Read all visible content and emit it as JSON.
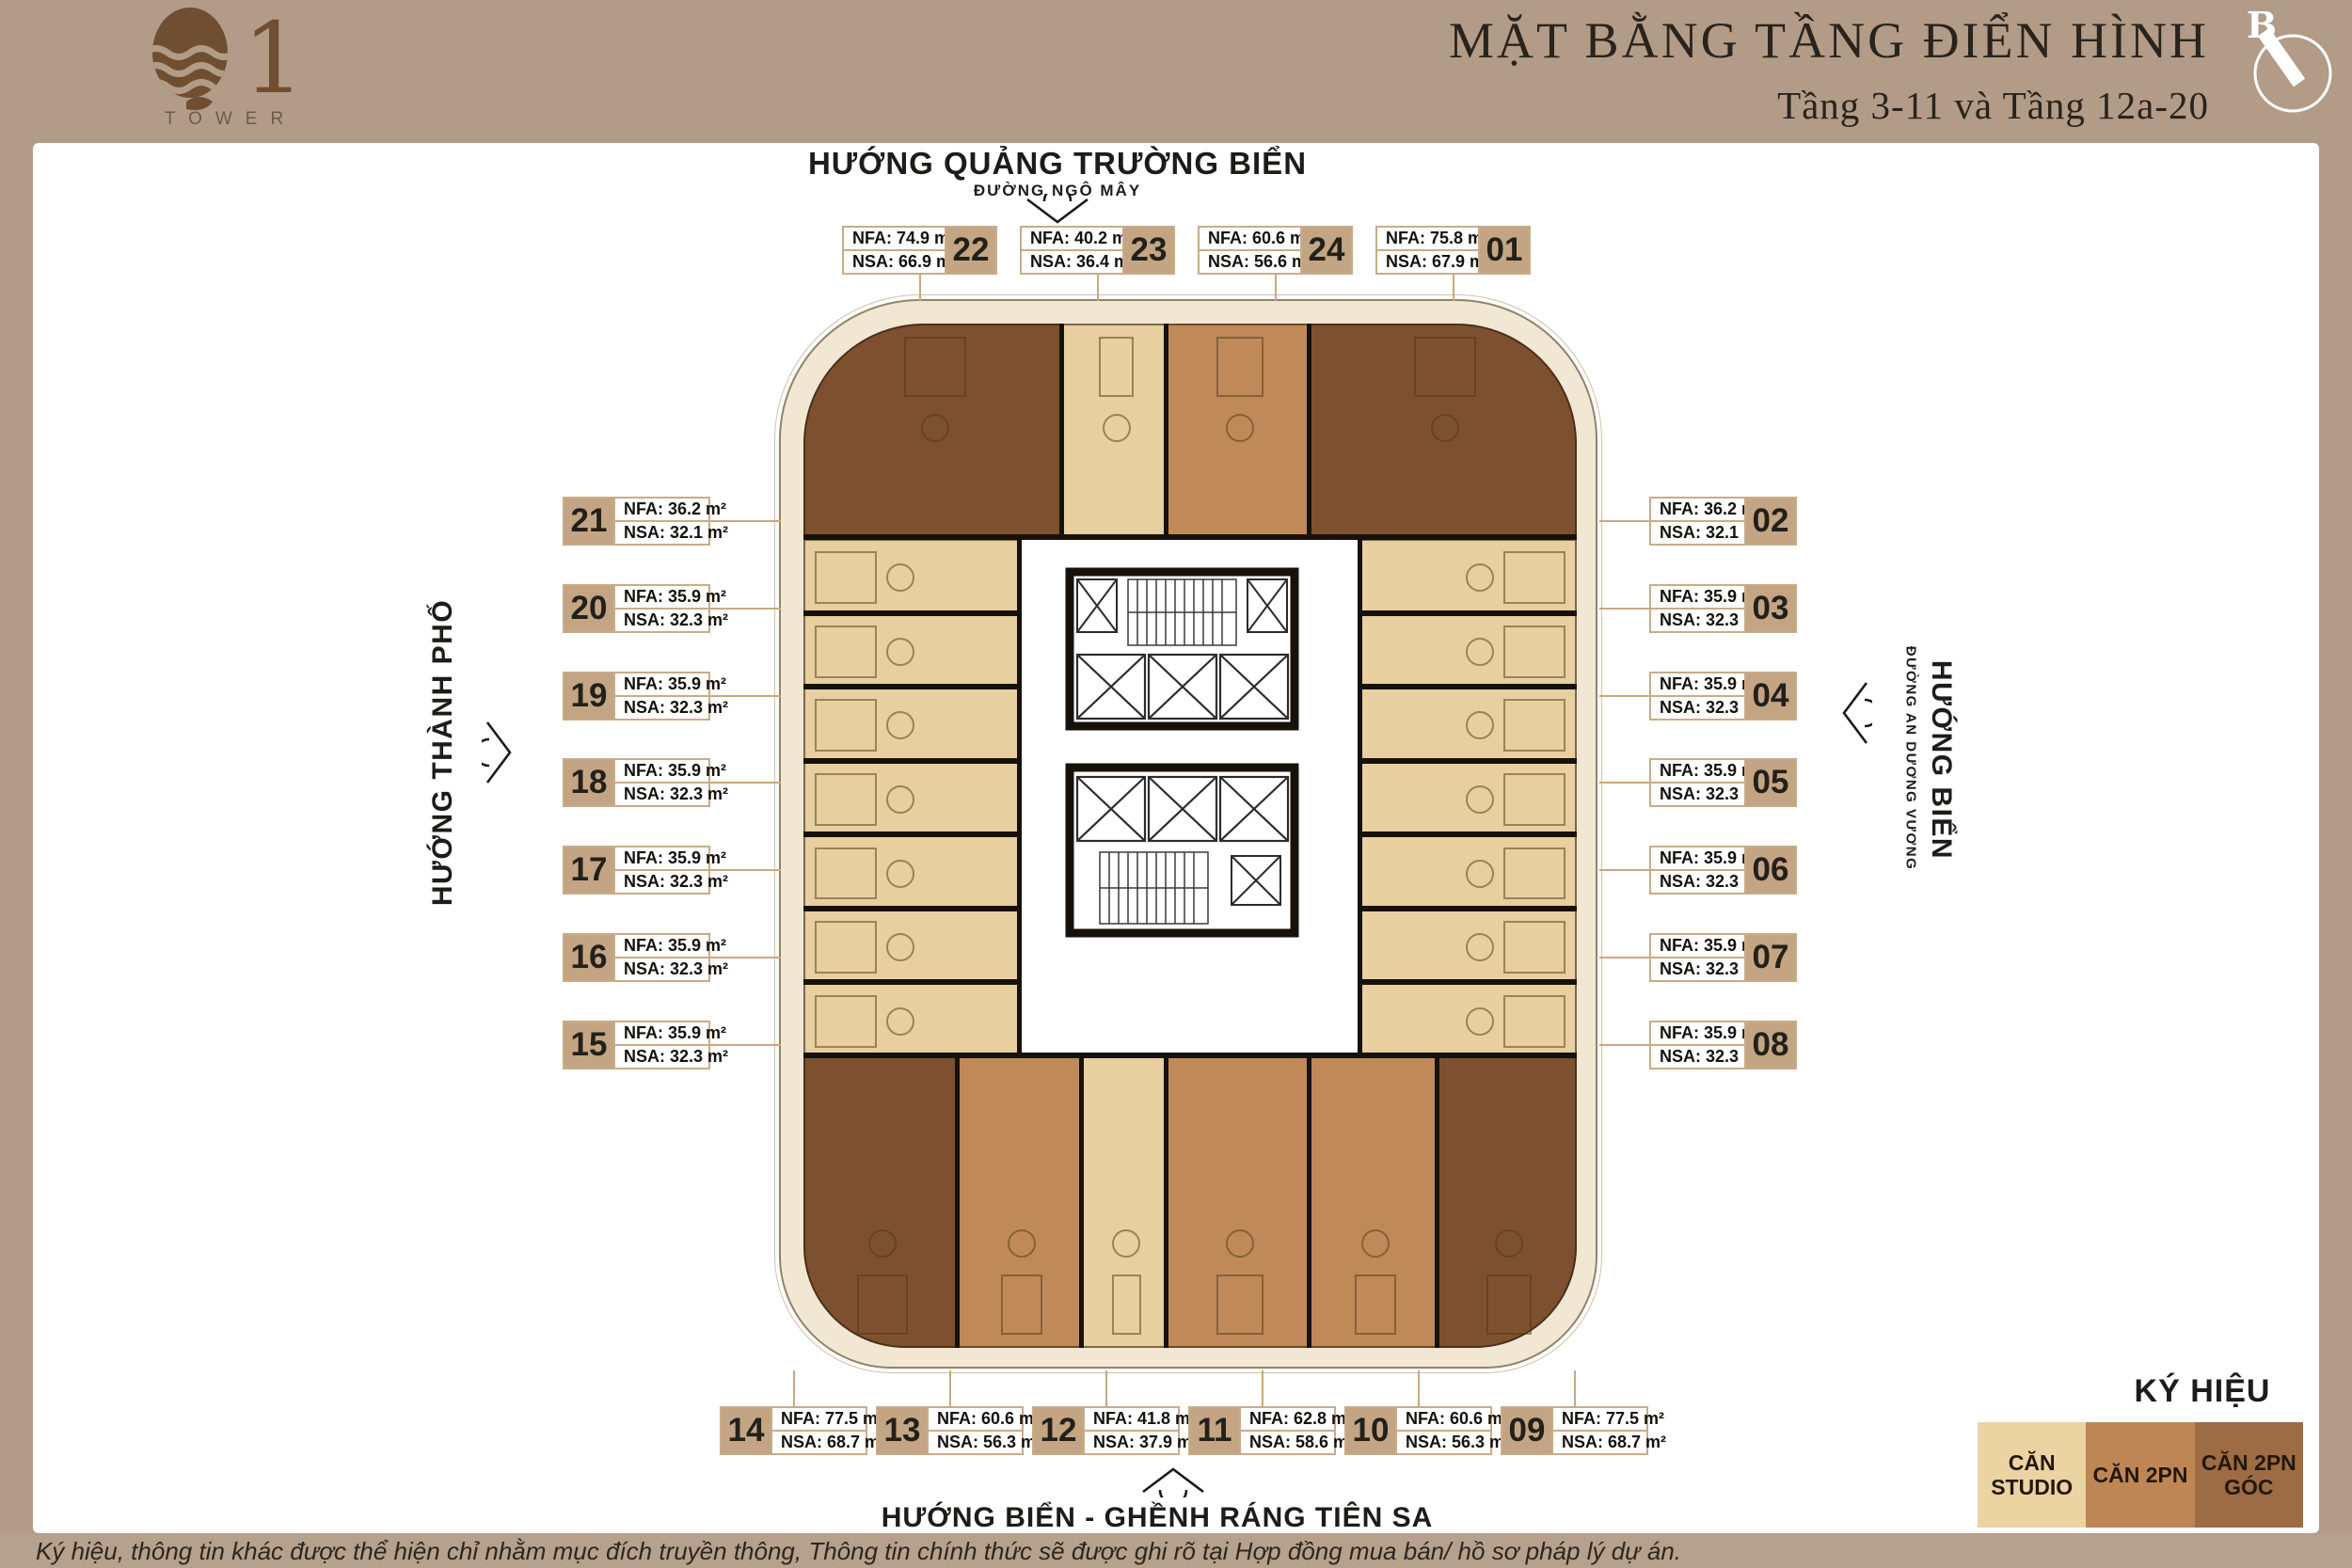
{
  "logo": {
    "mark": "Q1",
    "name": "TOWER"
  },
  "header": {
    "title": "MẶT BẰNG TẦNG ĐIỂN HÌNH",
    "subtitle": "Tầng 3-11 và Tầng 12a-20",
    "compass_label": "B"
  },
  "directions": {
    "top_heading": "HƯỚNG QUẢNG TRƯỜNG BIỂN",
    "top_road": "ĐƯỜNG NGÔ MÂY",
    "left_heading": "HƯỚNG THÀNH PHỐ",
    "right_heading": "HƯỚNG BIỂN",
    "right_road": "ĐƯỜNG AN DƯƠNG VƯƠNG",
    "bottom_heading": "HƯỚNG BIỂN - GHỀNH RÁNG TIÊN SA"
  },
  "unit_label_format": {
    "nfa_prefix": "NFA:",
    "nsa_prefix": "NSA:",
    "area_suffix": "m²"
  },
  "units": [
    {
      "id": "01",
      "nfa": "75.8",
      "nsa": "67.9",
      "type": "2pn-goc"
    },
    {
      "id": "02",
      "nfa": "36.2",
      "nsa": "32.1",
      "type": "studio"
    },
    {
      "id": "03",
      "nfa": "35.9",
      "nsa": "32.3",
      "type": "studio"
    },
    {
      "id": "04",
      "nfa": "35.9",
      "nsa": "32.3",
      "type": "studio"
    },
    {
      "id": "05",
      "nfa": "35.9",
      "nsa": "32.3",
      "type": "studio"
    },
    {
      "id": "06",
      "nfa": "35.9",
      "nsa": "32.3",
      "type": "studio"
    },
    {
      "id": "07",
      "nfa": "35.9",
      "nsa": "32.3",
      "type": "studio"
    },
    {
      "id": "08",
      "nfa": "35.9",
      "nsa": "32.3",
      "type": "studio"
    },
    {
      "id": "09",
      "nfa": "77.5",
      "nsa": "68.7",
      "type": "2pn-goc"
    },
    {
      "id": "10",
      "nfa": "60.6",
      "nsa": "56.3",
      "type": "2pn"
    },
    {
      "id": "11",
      "nfa": "62.8",
      "nsa": "58.6",
      "type": "2pn"
    },
    {
      "id": "12",
      "nfa": "41.8",
      "nsa": "37.9",
      "type": "studio"
    },
    {
      "id": "13",
      "nfa": "60.6",
      "nsa": "56.3",
      "type": "2pn"
    },
    {
      "id": "14",
      "nfa": "77.5",
      "nsa": "68.7",
      "type": "2pn-goc"
    },
    {
      "id": "15",
      "nfa": "35.9",
      "nsa": "32.3",
      "type": "studio"
    },
    {
      "id": "16",
      "nfa": "35.9",
      "nsa": "32.3",
      "type": "studio"
    },
    {
      "id": "17",
      "nfa": "35.9",
      "nsa": "32.3",
      "type": "studio"
    },
    {
      "id": "18",
      "nfa": "35.9",
      "nsa": "32.3",
      "type": "studio"
    },
    {
      "id": "19",
      "nfa": "35.9",
      "nsa": "32.3",
      "type": "studio"
    },
    {
      "id": "20",
      "nfa": "35.9",
      "nsa": "32.3",
      "type": "studio"
    },
    {
      "id": "21",
      "nfa": "36.2",
      "nsa": "32.1",
      "type": "studio"
    },
    {
      "id": "22",
      "nfa": "74.9",
      "nsa": "66.9",
      "type": "2pn-goc"
    },
    {
      "id": "23",
      "nfa": "40.2",
      "nsa": "36.4",
      "type": "studio"
    },
    {
      "id": "24",
      "nfa": "60.6",
      "nsa": "56.6",
      "type": "2pn"
    }
  ],
  "legend": {
    "title": "KÝ HIỆU",
    "items": [
      {
        "label": "CĂN STUDIO",
        "color": "#ecd3a2"
      },
      {
        "label": "CĂN 2PN",
        "color": "#bf8655"
      },
      {
        "label": "CĂN 2PN GÓC",
        "color": "#9d6c44"
      }
    ]
  },
  "plan_colors": {
    "studio": "#e7cf9f",
    "2pn": "#c08a58",
    "2pn-goc": "#7d512f",
    "base": "#f1e7d3",
    "wall": "#17110b",
    "banner": "#b29c87",
    "label_accent": "#c3a584"
  },
  "disclaimer": "Ký hiệu, thông tin khác được thể hiện chỉ nhằm mục đích truyền thông, Thông tin chính thức sẽ được ghi rõ tại Hợp đồng mua bán/ hồ sơ pháp lý dự án."
}
